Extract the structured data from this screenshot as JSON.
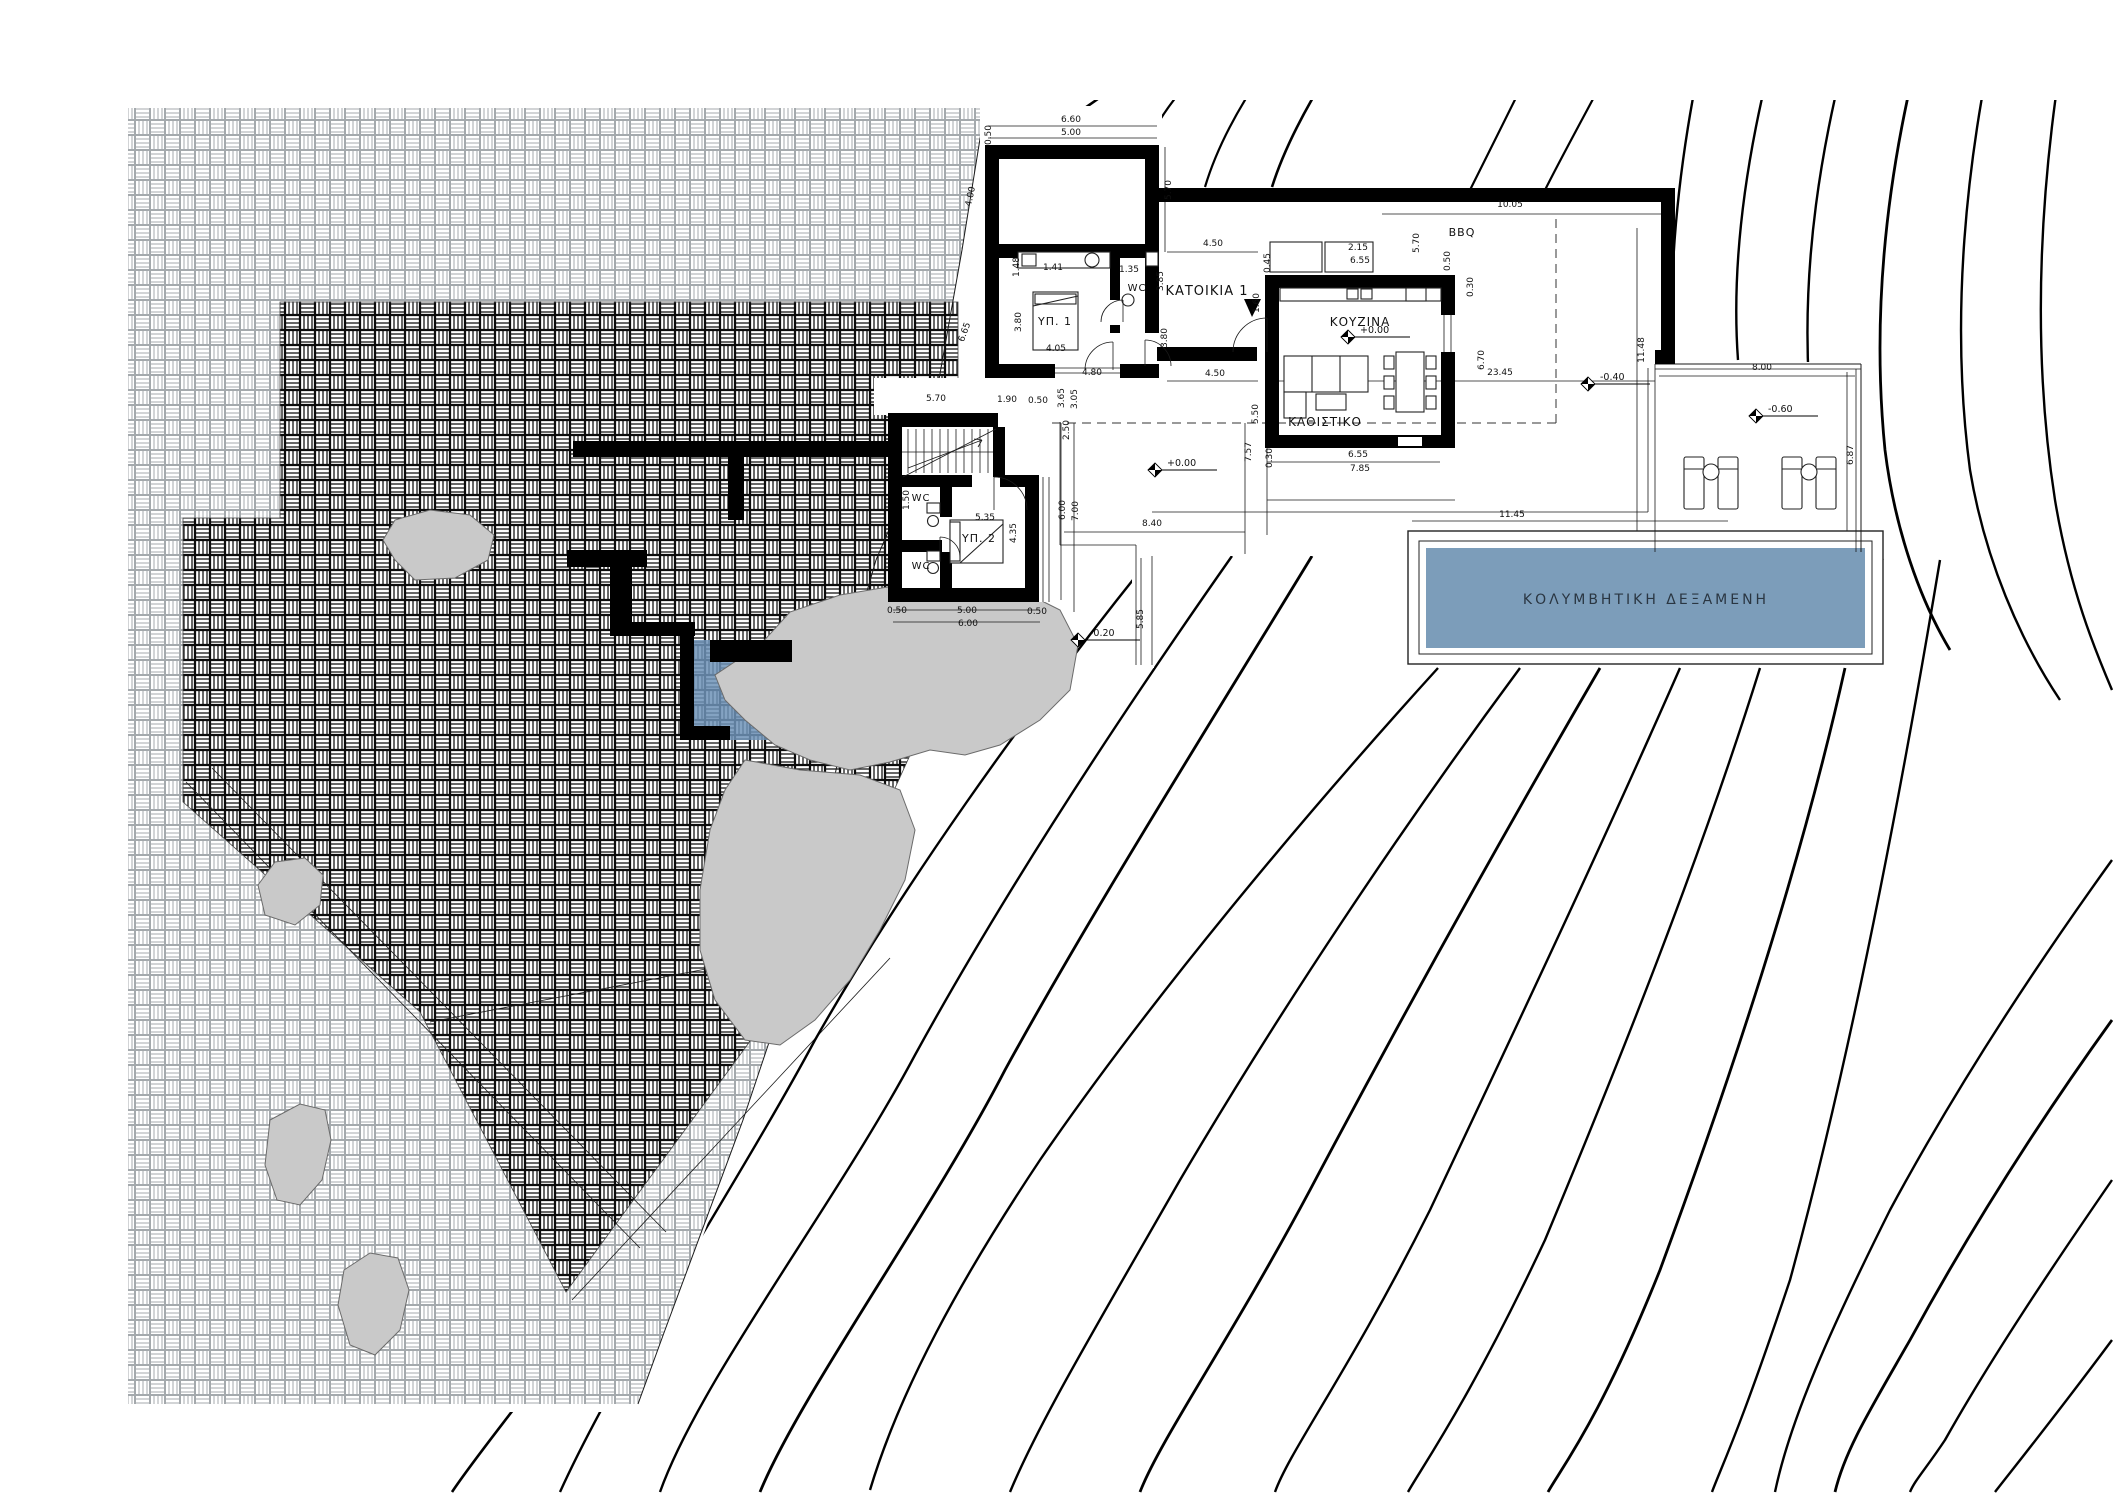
{
  "plan": {
    "rooms": [
      {
        "id": "residence-1",
        "label": "ΚΑΤΟΙΚΙΑ 1"
      },
      {
        "id": "kitchen",
        "label": "ΚΟΥΖΙΝΑ"
      },
      {
        "id": "living-room",
        "label": "ΚΑΘΙΣΤΙΚΟ"
      },
      {
        "id": "bedroom-1",
        "label": "ΥΠ. 1"
      },
      {
        "id": "bedroom-2",
        "label": "ΥΠ. 2"
      },
      {
        "id": "wc-a",
        "label": "WC"
      },
      {
        "id": "wc-b",
        "label": "WC"
      },
      {
        "id": "wc-c",
        "label": "WC"
      },
      {
        "id": "bbq",
        "label": "BBQ"
      },
      {
        "id": "swimming-pool",
        "label": "ΚΟΛΥΜΒΗΤΙΚΗ ΔΕΞΑΜΕΝΗ"
      }
    ],
    "levels": [
      {
        "t": "+0.00",
        "x": 1348,
        "y": 337
      },
      {
        "t": "+0.00",
        "x": 1155,
        "y": 470
      },
      {
        "t": "-0.20",
        "x": 1078,
        "y": 640
      },
      {
        "t": "-0.40",
        "x": 1588,
        "y": 384
      },
      {
        "t": "-0.60",
        "x": 1756,
        "y": 416
      }
    ],
    "dims": [
      {
        "t": "6.60",
        "x": 1071,
        "y": 122
      },
      {
        "t": "5.00",
        "x": 1071,
        "y": 135
      },
      {
        "t": "0.50",
        "x": 991,
        "y": 135,
        "r": -90
      },
      {
        "t": "5.70",
        "x": 1171,
        "y": 190,
        "r": -90
      },
      {
        "t": "4.00",
        "x": 973,
        "y": 197,
        "r": -78
      },
      {
        "t": "6.65",
        "x": 967,
        "y": 333,
        "r": -70
      },
      {
        "t": "4.50",
        "x": 1213,
        "y": 246
      },
      {
        "t": "3.85",
        "x": 1163,
        "y": 281,
        "r": -90
      },
      {
        "t": "1.60",
        "x": 1259,
        "y": 303,
        "r": -90
      },
      {
        "t": "3.80",
        "x": 1167,
        "y": 338,
        "r": -90
      },
      {
        "t": "1.48",
        "x": 1019,
        "y": 267,
        "r": -90
      },
      {
        "t": "1.41",
        "x": 1053,
        "y": 270
      },
      {
        "t": "1.35",
        "x": 1129,
        "y": 272
      },
      {
        "t": "3.80",
        "x": 1021,
        "y": 322,
        "r": -90
      },
      {
        "t": "4.05",
        "x": 1056,
        "y": 351
      },
      {
        "t": "4.80",
        "x": 1092,
        "y": 375
      },
      {
        "t": "4.50",
        "x": 1215,
        "y": 376
      },
      {
        "t": "5.50",
        "x": 1258,
        "y": 414,
        "r": -90
      },
      {
        "t": "3.65",
        "x": 1064,
        "y": 398,
        "r": -90
      },
      {
        "t": "3.05",
        "x": 1077,
        "y": 399,
        "r": -90
      },
      {
        "t": "5.70",
        "x": 936,
        "y": 401
      },
      {
        "t": "1.90",
        "x": 1007,
        "y": 402
      },
      {
        "t": "0.50",
        "x": 1038,
        "y": 403
      },
      {
        "t": "2.50",
        "x": 1069,
        "y": 430,
        "r": -90
      },
      {
        "t": "1.50",
        "x": 909,
        "y": 500,
        "r": -90
      },
      {
        "t": "5.35",
        "x": 985,
        "y": 520
      },
      {
        "t": "4.35",
        "x": 1016,
        "y": 533,
        "r": -90
      },
      {
        "t": "6.00",
        "x": 1065,
        "y": 510,
        "r": -90
      },
      {
        "t": "7.00",
        "x": 1078,
        "y": 511,
        "r": -90
      },
      {
        "t": "0.50",
        "x": 897,
        "y": 613
      },
      {
        "t": "5.00",
        "x": 967,
        "y": 613
      },
      {
        "t": "6.00",
        "x": 968,
        "y": 626
      },
      {
        "t": "0.50",
        "x": 1037,
        "y": 614
      },
      {
        "t": "5.85",
        "x": 1143,
        "y": 619,
        "r": -90
      },
      {
        "t": "5.70",
        "x": 1419,
        "y": 243,
        "r": -90
      },
      {
        "t": "2.15",
        "x": 1358,
        "y": 250
      },
      {
        "t": "6.55",
        "x": 1360,
        "y": 263
      },
      {
        "t": "0.45",
        "x": 1270,
        "y": 263,
        "r": -90
      },
      {
        "t": "0.50",
        "x": 1450,
        "y": 261,
        "r": -90
      },
      {
        "t": "10.05",
        "x": 1510,
        "y": 207
      },
      {
        "t": "11.48",
        "x": 1644,
        "y": 350,
        "r": -90
      },
      {
        "t": "0.30",
        "x": 1473,
        "y": 287,
        "r": -90
      },
      {
        "t": "6.70",
        "x": 1484,
        "y": 360,
        "r": -90
      },
      {
        "t": "7.57",
        "x": 1251,
        "y": 452,
        "r": -90
      },
      {
        "t": "6.55",
        "x": 1358,
        "y": 457
      },
      {
        "t": "7.85",
        "x": 1360,
        "y": 471
      },
      {
        "t": "0.30",
        "x": 1272,
        "y": 458,
        "r": -90
      },
      {
        "t": "8.40",
        "x": 1152,
        "y": 526
      },
      {
        "t": "23.45",
        "x": 1500,
        "y": 375
      },
      {
        "t": "11.45",
        "x": 1512,
        "y": 517
      },
      {
        "t": "8.00",
        "x": 1762,
        "y": 370
      },
      {
        "t": "6.87",
        "x": 1853,
        "y": 455,
        "r": -90
      }
    ],
    "colors": {
      "pool_water": "#7C9DBA",
      "plunge_pool": "#6E93B7",
      "rock_fill": "#C9C9C9",
      "line": "#000000"
    }
  }
}
